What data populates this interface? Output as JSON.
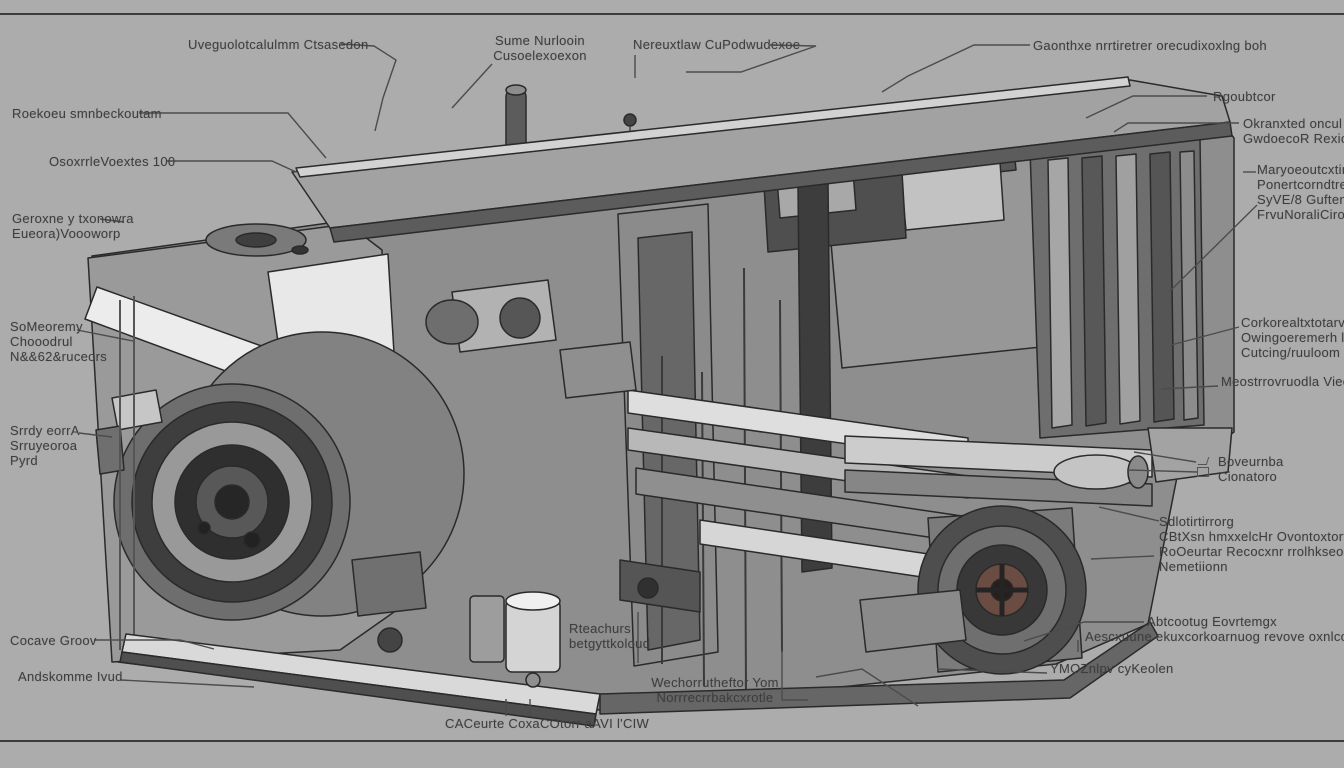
{
  "page": {
    "background_color": "#acacac",
    "frame_line_color": "#3c3c3c"
  },
  "illustration": {
    "name": "machine-cutaway-illustration",
    "palette": {
      "outline": "#262626",
      "metal_light": "#e9e9e9",
      "metal_mid": "#9a9a9a",
      "metal_dark": "#4a4a4a",
      "hub_tint": "#6b4c42",
      "leader_line": "#4c4c4c",
      "label_text": "#3e3e3e"
    }
  },
  "icons": {
    "component_icon": "small-box-with-pointer"
  },
  "labels": [
    {
      "text": "Uveguolotcalulmm Ctsasedon"
    },
    {
      "text": "Roekoeu smnbeckoutam"
    },
    {
      "text": "OsoxrrleVoextes 100"
    },
    {
      "text": "Geroxne y txonowra\nEueora)Voooworp"
    },
    {
      "text": "Sume Nurlooin\nCusoelexoexon"
    },
    {
      "text": "Nereuxtlaw CuPodwudexoe"
    },
    {
      "text": "Gaonthxe nrrtiretrer orecudixoxlng boh"
    },
    {
      "text": "Rgoubtcor"
    },
    {
      "text": "Okranxted oncul Go\nGwdoecoR Rexiownr"
    },
    {
      "text": "Maryoeoutcxtirrt\nPonertcorndtrenioo\nSyVE/8 Guftenuuet\nFrvuNoraliCirod"
    },
    {
      "text": "Corkorealtxtotarvlnc\nOwingoeremerh luket\nCutcing/ruuloom"
    },
    {
      "text": "Meostrrovruodla Vieoette"
    },
    {
      "text": "Boveurnba\nCionatoro"
    },
    {
      "text": "Sdlotirtirrorg\nCBtXsn hmxxelcHr Ovontoxtortorru\nRoOeurtar Recocxnr rrolhkseors Ecrn\nNemetiionn"
    },
    {
      "text": "Abtcootug Eovrtemgx"
    },
    {
      "text": "Aescxuune ekuxcorkoarnuog revove oxnlcool Notre"
    },
    {
      "text": "YMOZnlpv cyKeolen"
    },
    {
      "text": "Rteachurs\nbetgyttkoloud"
    },
    {
      "text": "Wechorrutheftor Yom\nNorrrecrrbakcxrotle"
    },
    {
      "text": "CACeurte CoxaCOtorr aAVI l'CIW"
    },
    {
      "text": "SoMeoremy\nChooodrul\nN&&62&ruceors"
    },
    {
      "text": "Srrdy eorrA\nSrruyeoroa\nPyrd"
    },
    {
      "text": "Cocave Groov"
    },
    {
      "text": "Andskomme Ivud"
    }
  ]
}
